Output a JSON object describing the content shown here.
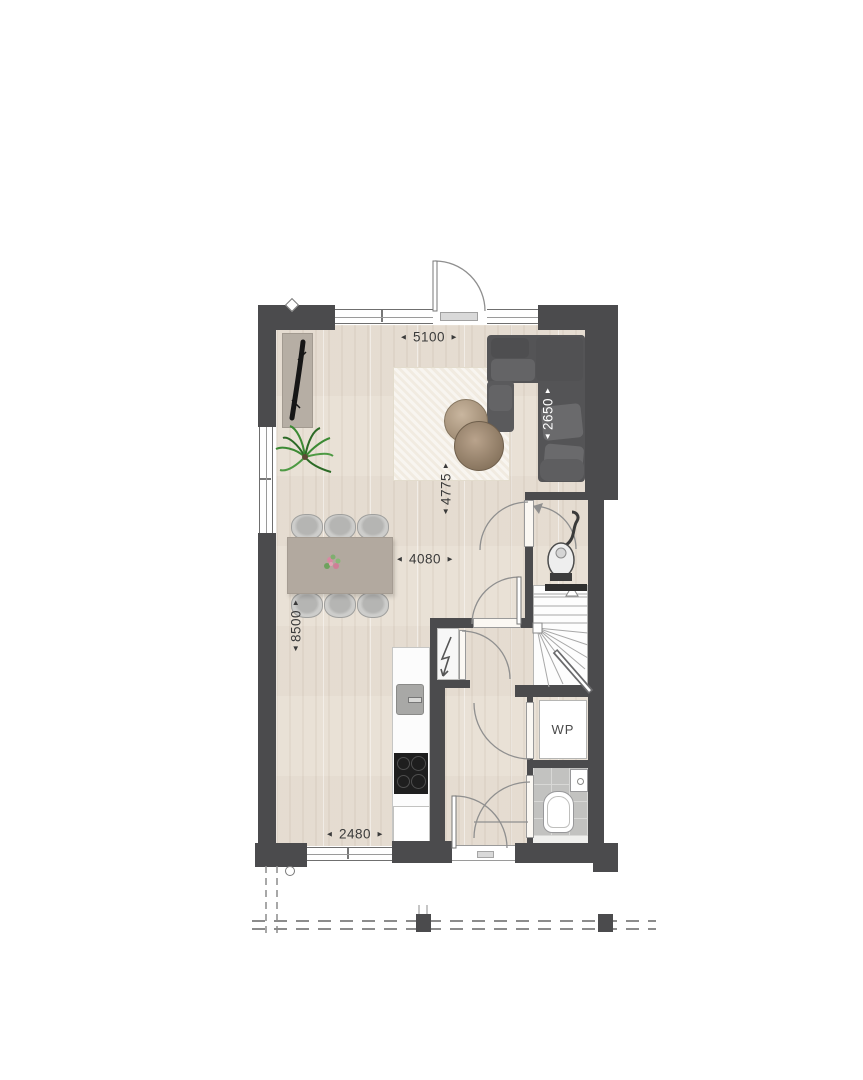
{
  "plan": {
    "title_note": "ground floor plan",
    "labels": {
      "heat_pump": "WP"
    },
    "dimensions": {
      "top_width": "5100",
      "sofa_depth": "2650",
      "living_depth": "4775",
      "mid_width": "4080",
      "left_depth": "8500",
      "kitchen_width": "2480"
    },
    "glyphs": {
      "arrow_left": "◄",
      "arrow_right": "►",
      "arrow_up": "▲",
      "arrow_down": "▼"
    },
    "colors": {
      "wall": "#4b4b4d",
      "wood_floor": "#e9e1d6",
      "tile_floor": "#c2c2c0",
      "sofa": "#545456",
      "table_wood": "#8f7b63",
      "plant_green": "#3c8a34",
      "dimension_text": "#3a3a3a",
      "linework": "#8f8f8f"
    }
  }
}
